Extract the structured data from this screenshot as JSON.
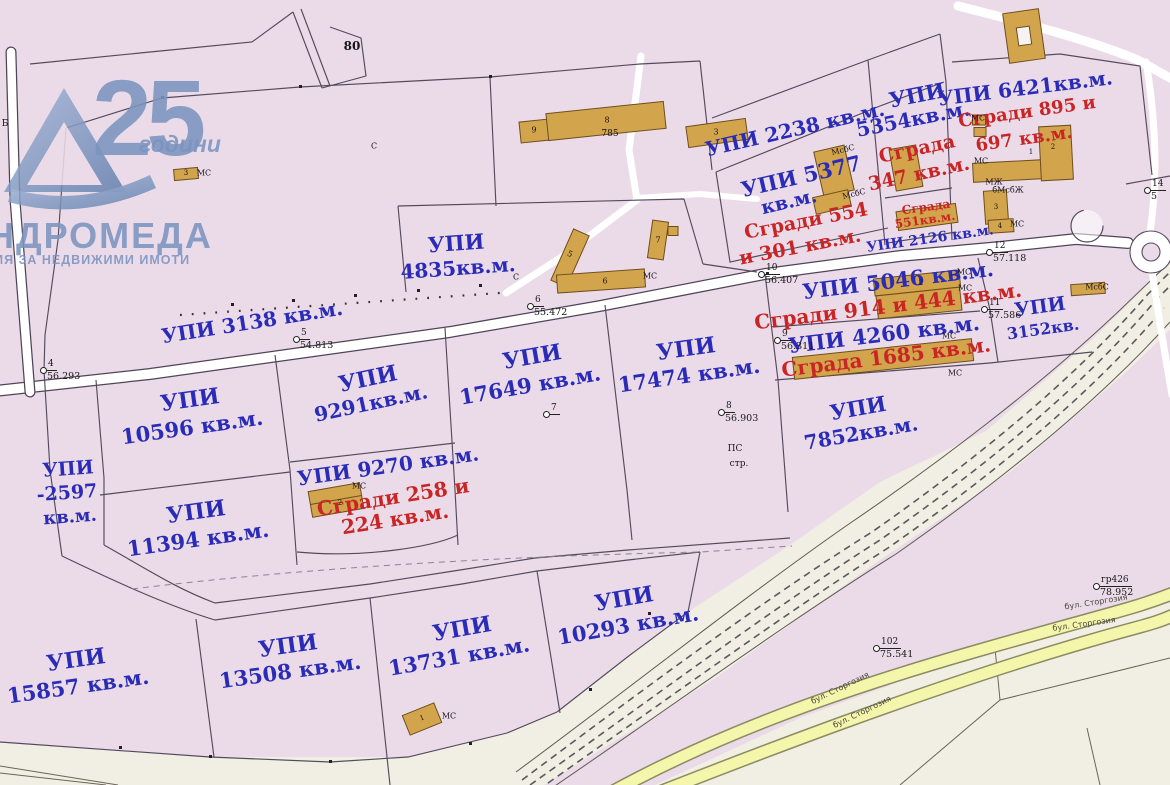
{
  "watermark": {
    "number": "25",
    "years_word": "години",
    "agency_name_partial": "НДРОМЕДА",
    "agency_tagline_partial": "ЦИЯ ЗА НЕДВИЖИМИ ИМОТИ",
    "click_text": "lick here"
  },
  "colors": {
    "parcel_pink": "#ebdbe9",
    "outside_beige": "#f1eee3",
    "boundary_line": "#544a5e",
    "parcel_text_blue": "#2a2cb8",
    "building_text_red": "#c92525",
    "building_fill_tan": "#d2a44c",
    "boulevard_yellow": "#f3f6ab",
    "watermark_blue": "#7b94c0"
  },
  "map": {
    "parcel_labels": [
      {
        "n": "upi-3138",
        "t": "УПИ 3138 кв.м.",
        "x": 252,
        "y": 322,
        "r": -9,
        "s": 20
      },
      {
        "n": "upi-4835-a",
        "t": "УПИ",
        "x": 456,
        "y": 243,
        "r": -4,
        "s": 21
      },
      {
        "n": "upi-4835-b",
        "t": "4835кв.м.",
        "x": 458,
        "y": 268,
        "r": -4,
        "s": 20
      },
      {
        "n": "upi-2238",
        "t": "УПИ 2238 кв.м.",
        "x": 795,
        "y": 129,
        "r": -13,
        "s": 20
      },
      {
        "n": "upi-5354-a",
        "t": "УПИ",
        "x": 917,
        "y": 95,
        "r": -11,
        "s": 21
      },
      {
        "n": "upi-5354-b",
        "t": "5354кв.м.",
        "x": 913,
        "y": 119,
        "r": -11,
        "s": 20
      },
      {
        "n": "upi-5377-a",
        "t": "УПИ 5377",
        "x": 801,
        "y": 176,
        "r": -13,
        "s": 21
      },
      {
        "n": "upi-5377-b",
        "t": "кв.м.",
        "x": 789,
        "y": 202,
        "r": -13,
        "s": 19
      },
      {
        "n": "upi-2126",
        "t": "УПИ 2126 кв.м.",
        "x": 930,
        "y": 239,
        "r": -8,
        "s": 14
      },
      {
        "n": "upi-6421",
        "t": "УПИ 6421кв.м.",
        "x": 1025,
        "y": 88,
        "r": -7,
        "s": 20
      },
      {
        "n": "upi-5046",
        "t": "УПИ 5046 кв.м.",
        "x": 898,
        "y": 280,
        "r": -7,
        "s": 21
      },
      {
        "n": "upi-4260",
        "t": "УПИ 4260 кв.м.",
        "x": 884,
        "y": 334,
        "r": -7,
        "s": 21
      },
      {
        "n": "upi-3152-a",
        "t": "УПИ",
        "x": 1040,
        "y": 307,
        "r": -8,
        "s": 19
      },
      {
        "n": "upi-3152-b",
        "t": "3152кв.",
        "x": 1043,
        "y": 329,
        "r": -8,
        "s": 16
      },
      {
        "n": "upi-10596-a",
        "t": "УПИ",
        "x": 190,
        "y": 400,
        "r": -8,
        "s": 22
      },
      {
        "n": "upi-10596-b",
        "t": "10596 кв.м.",
        "x": 192,
        "y": 427,
        "r": -8,
        "s": 21
      },
      {
        "n": "upi-9291-a",
        "t": "УПИ",
        "x": 368,
        "y": 379,
        "r": -12,
        "s": 22
      },
      {
        "n": "upi-9291-b",
        "t": "9291кв.м.",
        "x": 371,
        "y": 403,
        "r": -12,
        "s": 20
      },
      {
        "n": "upi-17649-a",
        "t": "УПИ",
        "x": 532,
        "y": 357,
        "r": -10,
        "s": 22
      },
      {
        "n": "upi-17649-b",
        "t": "17649 кв.м.",
        "x": 530,
        "y": 385,
        "r": -10,
        "s": 21
      },
      {
        "n": "upi-17474-a",
        "t": "УПИ",
        "x": 686,
        "y": 349,
        "r": -8,
        "s": 22
      },
      {
        "n": "upi-17474-b",
        "t": "17474 кв.м.",
        "x": 689,
        "y": 375,
        "r": -8,
        "s": 21
      },
      {
        "n": "upi-7852-a",
        "t": "УПИ",
        "x": 858,
        "y": 408,
        "r": -10,
        "s": 21
      },
      {
        "n": "upi-7852-b",
        "t": "7852кв.м.",
        "x": 861,
        "y": 433,
        "r": -10,
        "s": 20
      },
      {
        "n": "upi-2597-a",
        "t": "УПИ",
        "x": 68,
        "y": 469,
        "r": -4,
        "s": 19
      },
      {
        "n": "upi-2597-b",
        "t": "-2597",
        "x": 67,
        "y": 493,
        "r": -4,
        "s": 19
      },
      {
        "n": "upi-2597-c",
        "t": "кв.м.",
        "x": 70,
        "y": 517,
        "r": -4,
        "s": 18
      },
      {
        "n": "upi-11394-a",
        "t": "УПИ",
        "x": 196,
        "y": 512,
        "r": -8,
        "s": 22
      },
      {
        "n": "upi-11394-b",
        "t": "11394 кв.м.",
        "x": 198,
        "y": 539,
        "r": -8,
        "s": 21
      },
      {
        "n": "upi-9270",
        "t": "УПИ 9270 кв.м.",
        "x": 388,
        "y": 466,
        "r": -8,
        "s": 20
      },
      {
        "n": "upi-15857-a",
        "t": "УПИ",
        "x": 76,
        "y": 660,
        "r": -8,
        "s": 22
      },
      {
        "n": "upi-15857-b",
        "t": "15857 кв.м.",
        "x": 78,
        "y": 686,
        "r": -8,
        "s": 21
      },
      {
        "n": "upi-13508-a",
        "t": "УПИ",
        "x": 288,
        "y": 646,
        "r": -8,
        "s": 22
      },
      {
        "n": "upi-13508-b",
        "t": "13508 кв.м.",
        "x": 290,
        "y": 671,
        "r": -8,
        "s": 21
      },
      {
        "n": "upi-13731-a",
        "t": "УПИ",
        "x": 462,
        "y": 629,
        "r": -10,
        "s": 22
      },
      {
        "n": "upi-13731-b",
        "t": "13731 кв.м.",
        "x": 459,
        "y": 656,
        "r": -10,
        "s": 21
      },
      {
        "n": "upi-10293-a",
        "t": "УПИ",
        "x": 624,
        "y": 599,
        "r": -10,
        "s": 22
      },
      {
        "n": "upi-10293-b",
        "t": "10293 кв.м.",
        "x": 628,
        "y": 625,
        "r": -10,
        "s": 21
      }
    ],
    "building_labels": [
      {
        "n": "sgrada-347-a",
        "t": "Сграда",
        "x": 917,
        "y": 149,
        "r": -12,
        "s": 19
      },
      {
        "n": "sgrada-347-b",
        "t": "347 кв.м.",
        "x": 919,
        "y": 174,
        "r": -12,
        "s": 19
      },
      {
        "n": "sgradi-554-301-a",
        "t": "Сгради 554",
        "x": 806,
        "y": 221,
        "r": -11,
        "s": 19
      },
      {
        "n": "sgradi-554-301-b",
        "t": "и 301 кв.м.",
        "x": 800,
        "y": 247,
        "r": -11,
        "s": 19
      },
      {
        "n": "sgrada-551-a",
        "t": "Сграда",
        "x": 926,
        "y": 207,
        "r": -8,
        "s": 12
      },
      {
        "n": "sgrada-551-b",
        "t": "551кв.м.",
        "x": 925,
        "y": 220,
        "r": -8,
        "s": 12
      },
      {
        "n": "sgradi-895-697-a",
        "t": "Сгради 895 и",
        "x": 1027,
        "y": 112,
        "r": -8,
        "s": 18
      },
      {
        "n": "sgradi-895-697-b",
        "t": "697 кв.м.",
        "x": 1024,
        "y": 139,
        "r": -8,
        "s": 18
      },
      {
        "n": "sgradi-914-444",
        "t": "Сгради 914 и 444 кв.м.",
        "x": 888,
        "y": 306,
        "r": -7,
        "s": 20
      },
      {
        "n": "sgrada-1685",
        "t": "Сграда 1685 кв.м.",
        "x": 886,
        "y": 357,
        "r": -7,
        "s": 20
      },
      {
        "n": "sgradi-258-224-a",
        "t": "Сгради 258 и",
        "x": 393,
        "y": 497,
        "r": -9,
        "s": 20
      },
      {
        "n": "sgradi-258-224-b",
        "t": "224 кв.м.",
        "x": 395,
        "y": 519,
        "r": -9,
        "s": 20
      }
    ],
    "annotations": [
      {
        "n": "parcel-number-80",
        "t": "80",
        "x": 352,
        "y": 46,
        "s": 12,
        "b": 1
      },
      {
        "n": "building-number-785",
        "t": "785",
        "x": 610,
        "y": 134,
        "s": 9
      },
      {
        "n": "bldg-9",
        "t": "9",
        "x": 534,
        "y": 130,
        "s": 8
      },
      {
        "n": "bldg-8",
        "t": "8",
        "x": 607,
        "y": 120,
        "s": 8
      },
      {
        "n": "bldg-3-top",
        "t": "3",
        "x": 716,
        "y": 132,
        "s": 8
      },
      {
        "n": "bldg-5",
        "t": "5",
        "x": 570,
        "y": 254,
        "s": 8,
        "r": 24
      },
      {
        "n": "bldg-6",
        "t": "6",
        "x": 605,
        "y": 281,
        "s": 8
      },
      {
        "n": "bldg-7",
        "t": "7",
        "x": 658,
        "y": 240,
        "s": 8
      },
      {
        "n": "ms-1",
        "t": "МС",
        "x": 650,
        "y": 276,
        "s": 8
      },
      {
        "n": "s-1",
        "t": "С",
        "x": 516,
        "y": 277,
        "s": 8
      },
      {
        "n": "s-2",
        "t": "С",
        "x": 374,
        "y": 146,
        "s": 8
      },
      {
        "n": "ms-2",
        "t": "МС",
        "x": 204,
        "y": 173,
        "s": 8
      },
      {
        "n": "bldg-3-tl",
        "t": "3",
        "x": 186,
        "y": 173,
        "s": 7
      },
      {
        "n": "bldg-1-r",
        "t": "1",
        "x": 1031,
        "y": 152,
        "s": 7
      },
      {
        "n": "bldg-2-r",
        "t": "2",
        "x": 1053,
        "y": 147,
        "s": 7
      },
      {
        "n": "ms-3",
        "t": "МС",
        "x": 981,
        "y": 161,
        "s": 8
      },
      {
        "n": "mzh-1",
        "t": "МЖ",
        "x": 994,
        "y": 182,
        "s": 8
      },
      {
        "n": "ms-4",
        "t": "МС",
        "x": 978,
        "y": 118,
        "s": 8
      },
      {
        "n": "bmsbzh",
        "t": "бМсбЖ",
        "x": 1008,
        "y": 190,
        "s": 8
      },
      {
        "n": "bldg-3-r",
        "t": "3",
        "x": 996,
        "y": 207,
        "s": 7
      },
      {
        "n": "bldg-4-r",
        "t": "4",
        "x": 1000,
        "y": 226,
        "s": 7
      },
      {
        "n": "ms-5",
        "t": "МС",
        "x": 1017,
        "y": 224,
        "s": 8
      },
      {
        "n": "msbs-1",
        "t": "МсбС",
        "x": 843,
        "y": 150,
        "s": 8,
        "r": -14
      },
      {
        "n": "msbs-2",
        "t": "МсбС",
        "x": 854,
        "y": 194,
        "s": 8,
        "r": -14
      },
      {
        "n": "bldg-2-914",
        "t": "2",
        "x": 921,
        "y": 283,
        "s": 7
      },
      {
        "n": "ms-6",
        "t": "МС",
        "x": 964,
        "y": 272,
        "s": 8
      },
      {
        "n": "ms-7",
        "t": "МС",
        "x": 965,
        "y": 288,
        "s": 8
      },
      {
        "n": "ms-8",
        "t": "МС",
        "x": 949,
        "y": 336,
        "s": 8
      },
      {
        "n": "ms-9",
        "t": "МС",
        "x": 955,
        "y": 373,
        "s": 8
      },
      {
        "n": "msbs-3",
        "t": "МсбС",
        "x": 1097,
        "y": 287,
        "s": 8
      },
      {
        "n": "ms-10",
        "t": "МС",
        "x": 359,
        "y": 486,
        "s": 8
      },
      {
        "n": "bldg-2-9270",
        "t": "2",
        "x": 340,
        "y": 503,
        "s": 7
      },
      {
        "n": "ms-11",
        "t": "МС",
        "x": 449,
        "y": 716,
        "s": 8
      },
      {
        "n": "bldg-1-13731",
        "t": "1",
        "x": 422,
        "y": 718,
        "s": 7,
        "r": -20
      },
      {
        "n": "ps-note",
        "t": "ПС",
        "x": 735,
        "y": 449,
        "s": 9
      },
      {
        "n": "str-note",
        "t": "стр.",
        "x": 739,
        "y": 464,
        "s": 9
      },
      {
        "n": "edge-b",
        "t": "Б",
        "x": 5,
        "y": 124,
        "s": 9
      }
    ],
    "survey_points": [
      {
        "n": "pt-4",
        "id": "4",
        "e": "56.293",
        "x": 43,
        "y": 370
      },
      {
        "n": "pt-5",
        "id": "5",
        "e": "54.813",
        "x": 296,
        "y": 339
      },
      {
        "n": "pt-6",
        "id": "6",
        "e": "55.472",
        "x": 530,
        "y": 306
      },
      {
        "n": "pt-7",
        "id": "7",
        "e": "",
        "x": 546,
        "y": 414
      },
      {
        "n": "pt-8",
        "id": "8",
        "e": "56.903",
        "x": 721,
        "y": 412
      },
      {
        "n": "pt-9",
        "id": "9",
        "e": "56.311",
        "x": 777,
        "y": 340
      },
      {
        "n": "pt-10",
        "id": "10",
        "e": "56.407",
        "x": 761,
        "y": 274
      },
      {
        "n": "pt-11",
        "id": "11",
        "e": "57.586",
        "x": 984,
        "y": 309
      },
      {
        "n": "pt-12",
        "id": "12",
        "e": "57.118",
        "x": 989,
        "y": 252
      },
      {
        "n": "pt-14",
        "id": "14",
        "e": "5",
        "x": 1147,
        "y": 190
      },
      {
        "n": "pt-102",
        "id": "102",
        "e": "75.541",
        "x": 876,
        "y": 648
      },
      {
        "n": "pt-gr426",
        "id": "гр426",
        "e": "78.952",
        "x": 1096,
        "y": 586
      }
    ],
    "road_labels": [
      {
        "n": "blvd-storgozia-1",
        "t": "бул. Сторгозия",
        "x": 840,
        "y": 688,
        "r": -26,
        "s": 8
      },
      {
        "n": "blvd-storgozia-2",
        "t": "бул. Сторгозия",
        "x": 862,
        "y": 712,
        "r": -26,
        "s": 8
      },
      {
        "n": "blvd-storgozia-3",
        "t": "бул. Сторгозия",
        "x": 1096,
        "y": 602,
        "r": -9,
        "s": 8
      },
      {
        "n": "blvd-storgozia-4",
        "t": "бул. Сторгозия",
        "x": 1084,
        "y": 624,
        "r": -8,
        "s": 8
      }
    ]
  }
}
